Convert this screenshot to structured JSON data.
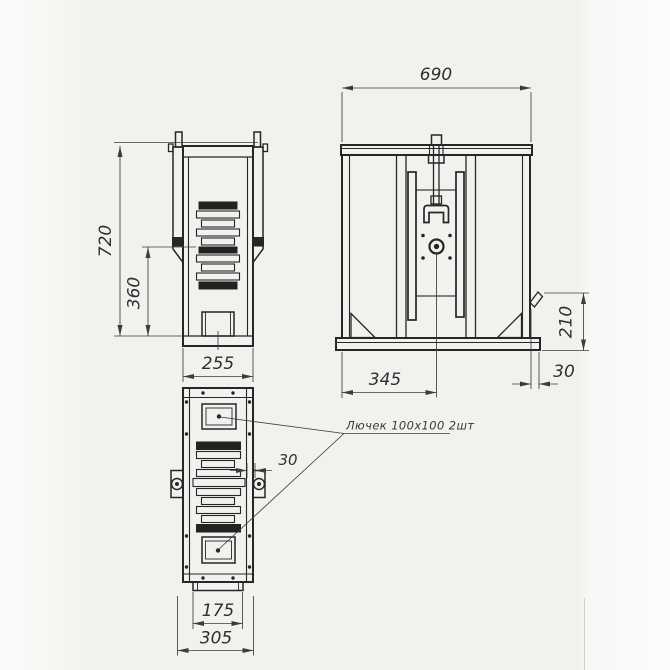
{
  "note": {
    "hatch_label": "Лючек 100х100 2шт"
  },
  "dims": {
    "front_height": "720",
    "front_mid_height": "360",
    "front_width": "255",
    "side_width": "690",
    "side_to_center": "345",
    "side_stub": "30",
    "side_bracket_height": "210",
    "plan_slat_offset": "30",
    "plan_inner_width": "175",
    "plan_outer_width": "305"
  },
  "colors": {
    "paper": "#f2f1ed",
    "ink": "#262626",
    "dim_line": "#3d3d3d"
  }
}
